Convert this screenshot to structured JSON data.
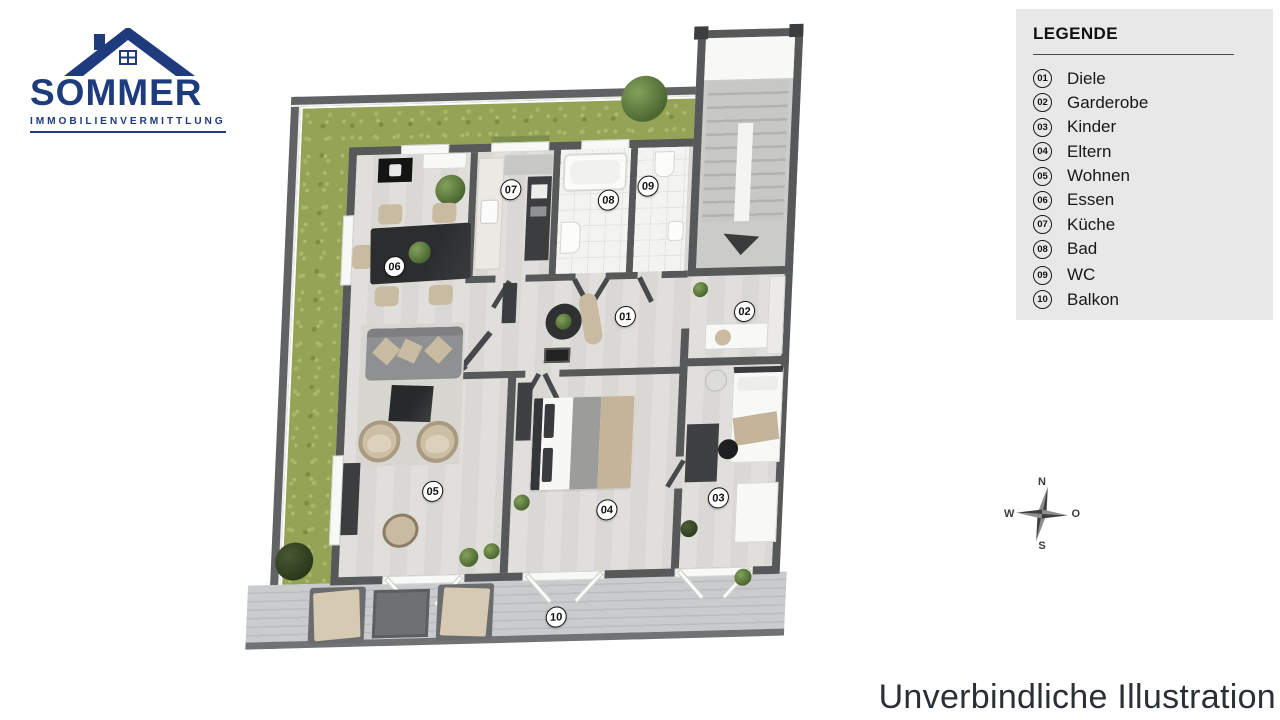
{
  "brand": {
    "name": "SOMMER",
    "subtitle": "IMMOBILIENVERMITTLUNG"
  },
  "legend": {
    "title": "LEGENDE",
    "items": [
      {
        "num": "01",
        "label": "Diele"
      },
      {
        "num": "02",
        "label": "Garderobe"
      },
      {
        "num": "03",
        "label": "Kinder"
      },
      {
        "num": "04",
        "label": "Eltern"
      },
      {
        "num": "05",
        "label": "Wohnen"
      },
      {
        "num": "06",
        "label": "Essen"
      },
      {
        "num": "07",
        "label": "Küche"
      },
      {
        "num": "08",
        "label": "Bad"
      },
      {
        "num": "09",
        "label": "WC"
      },
      {
        "num": "10",
        "label": "Balkon"
      }
    ]
  },
  "plan": {
    "badges": [
      {
        "label": "01",
        "room": "Diele"
      },
      {
        "label": "02",
        "room": "Garderobe"
      },
      {
        "label": "03",
        "room": "Kinder"
      },
      {
        "label": "04",
        "room": "Eltern"
      },
      {
        "label": "05",
        "room": "Wohnen"
      },
      {
        "label": "06",
        "room": "Essen"
      },
      {
        "label": "07",
        "room": "Küche"
      },
      {
        "label": "08",
        "room": "Bad"
      },
      {
        "label": "09",
        "room": "WC"
      },
      {
        "label": "10",
        "room": "Balkon"
      }
    ]
  },
  "compass": {
    "north": "N",
    "east": "O",
    "south": "S",
    "west": "W"
  },
  "footer": {
    "text": "Unverbindliche Illustration"
  },
  "colors": {
    "brand_navy": "#1d3b7d",
    "legend_bg": "#e8e8e8",
    "wall_gray": "#57585a",
    "grass_green": "#94a355",
    "floor_light": "#dedcd9",
    "deck_gray": "#c4c6c8"
  }
}
